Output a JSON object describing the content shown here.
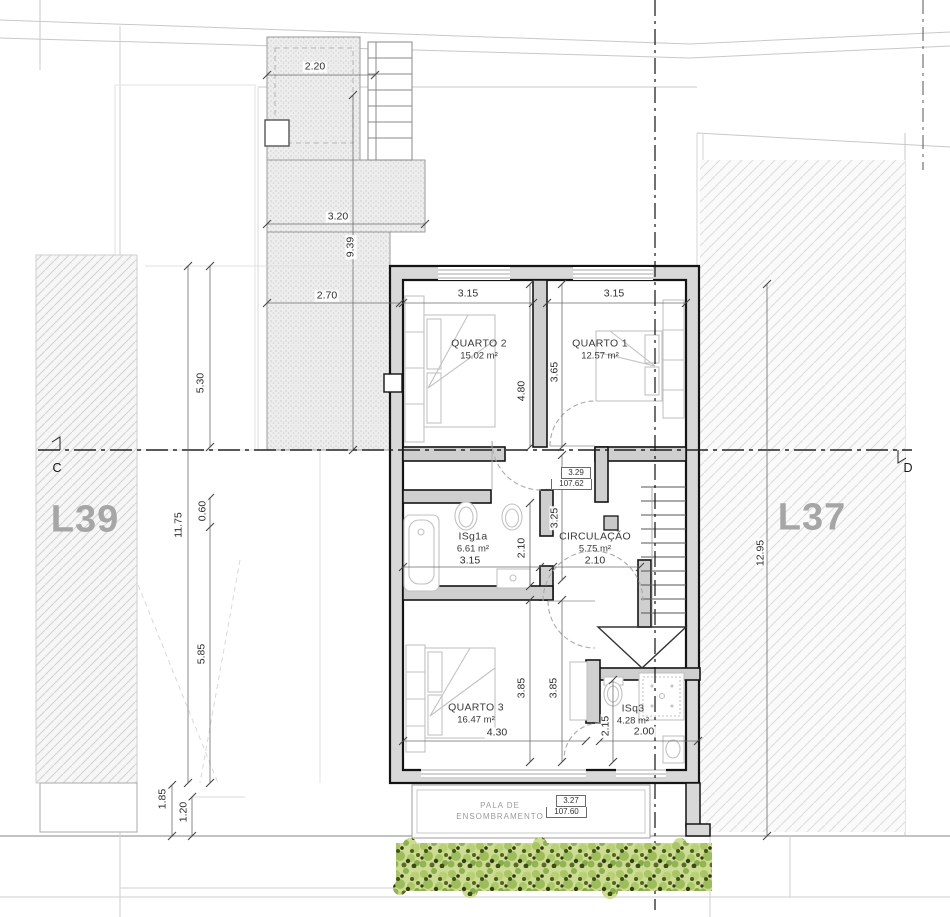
{
  "site": {
    "lot_left": "L39",
    "lot_right": "L37",
    "section_left": "C",
    "section_right": "D"
  },
  "rooms": [
    {
      "name": "QUARTO 2",
      "area": "15.02 m²",
      "x": 479,
      "y": 350
    },
    {
      "name": "QUARTO 1",
      "area": "12.57 m²",
      "x": 600,
      "y": 350
    },
    {
      "name": "ISg1a",
      "area": "6.61 m²",
      "x": 473,
      "y": 543
    },
    {
      "name": "CIRCULAÇÃO",
      "area": "5.75 m²",
      "x": 595,
      "y": 543
    },
    {
      "name": "QUARTO 3",
      "area": "16.47 m²",
      "x": 476,
      "y": 714
    },
    {
      "name": "ISq3",
      "area": "4.28 m²",
      "x": 633,
      "y": 715
    }
  ],
  "dimensions": [
    {
      "v": "2.20",
      "x": 315,
      "y": 67,
      "r": 0
    },
    {
      "v": "3.20",
      "x": 338,
      "y": 217,
      "r": 0
    },
    {
      "v": "9.39",
      "x": 351,
      "y": 247,
      "r": 90
    },
    {
      "v": "2.70",
      "x": 327,
      "y": 296,
      "r": 0
    },
    {
      "v": "5.30",
      "x": 201,
      "y": 383,
      "r": 90
    },
    {
      "v": "11.75",
      "x": 179,
      "y": 525,
      "r": 90
    },
    {
      "v": "0.60",
      "x": 203,
      "y": 511,
      "r": 90
    },
    {
      "v": "5.85",
      "x": 202,
      "y": 654,
      "r": 90
    },
    {
      "v": "1.85",
      "x": 163,
      "y": 799,
      "r": 90
    },
    {
      "v": "1.20",
      "x": 184,
      "y": 812,
      "r": 90
    },
    {
      "v": "12.95",
      "x": 761,
      "y": 553,
      "r": 90
    },
    {
      "v": "3.15",
      "x": 468,
      "y": 294,
      "r": 0
    },
    {
      "v": "3.15",
      "x": 614,
      "y": 294,
      "r": 0
    },
    {
      "v": "4.80",
      "x": 522,
      "y": 391,
      "r": 90
    },
    {
      "v": "3.65",
      "x": 555,
      "y": 372,
      "r": 90
    },
    {
      "v": "3.25",
      "x": 555,
      "y": 518,
      "r": 90
    },
    {
      "v": "2.10",
      "x": 522,
      "y": 548,
      "r": 90
    },
    {
      "v": "3.15",
      "x": 470,
      "y": 561,
      "r": 0
    },
    {
      "v": "2.10",
      "x": 595,
      "y": 561,
      "r": 0
    },
    {
      "v": "3.85",
      "x": 522,
      "y": 688,
      "r": 90
    },
    {
      "v": "3.85",
      "x": 554,
      "y": 688,
      "r": 90
    },
    {
      "v": "4.30",
      "x": 497,
      "y": 733,
      "r": 0
    },
    {
      "v": "2.15",
      "x": 606,
      "y": 726,
      "r": 90
    },
    {
      "v": "2.00",
      "x": 644,
      "y": 732,
      "r": 0
    }
  ],
  "elevation_markers": [
    {
      "level": "3.29",
      "altitude": "107.62"
    },
    {
      "level": "3.27",
      "altitude": "107.60"
    }
  ],
  "notes": {
    "pala_line1": "PALA DE",
    "pala_line2": "ENSOMBRAMENTO"
  },
  "colors": {
    "wall_fill": "#d8d8d8",
    "wall_line": "#141414",
    "vegetation_base": "#ccdc92",
    "vegetation_dark": "#3c4a16"
  }
}
